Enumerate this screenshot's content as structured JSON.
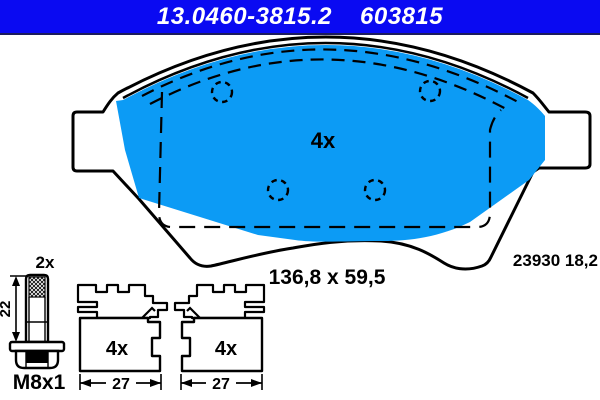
{
  "header": {
    "part_number": "13.0460-3815.2",
    "article_code": "603815"
  },
  "pad_top_view": {
    "quantity_label": "4x",
    "size_label": "136,8 x 59,5",
    "wva_label": "23930 18,2"
  },
  "bolt_drawing": {
    "quantity_label": "2x",
    "length_label": "22",
    "wrench_size_label": "SW13",
    "thread_label": "M8x1"
  },
  "profiles": {
    "left": {
      "quantity_label": "4x",
      "width_label": "27"
    },
    "right": {
      "quantity_label": "4x",
      "width_label": "27"
    }
  },
  "colors": {
    "header_bg": "#0a0af2",
    "header_text": "#ffffff",
    "pad_fill": "#0c9bf5",
    "line": "#000000"
  }
}
